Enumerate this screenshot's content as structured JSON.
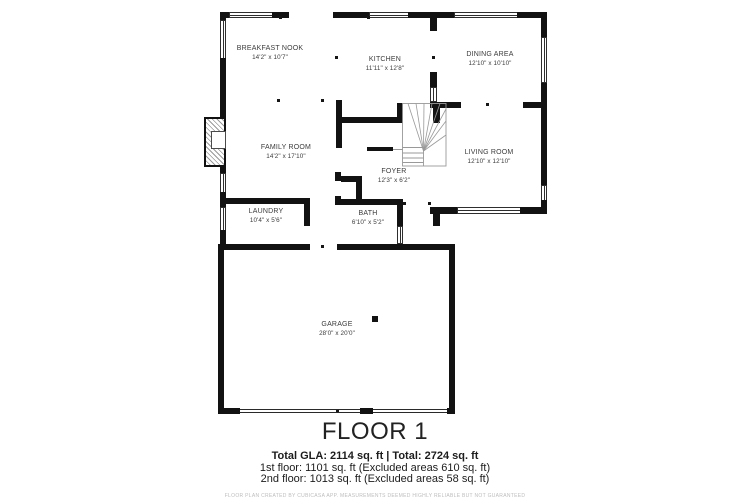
{
  "plan": {
    "floor_title": "FLOOR 1",
    "stats": {
      "total_line": "Total GLA: 2114 sq. ft | Total: 2724 sq. ft",
      "first_floor_line": "1st floor: 1101 sq. ft (Excluded areas 610 sq. ft)",
      "second_floor_line": "2nd floor: 1013 sq. ft (Excluded areas 58 sq. ft)"
    },
    "disclaimer": "FLOOR PLAN CREATED BY CUBICASA APP. MEASUREMENTS DEEMED HIGHLY RELIABLE BUT NOT GUARANTEED",
    "rooms": [
      {
        "name": "BREAKFAST NOOK",
        "dimensions": "14'2\" x 10'7\""
      },
      {
        "name": "KITCHEN",
        "dimensions": "11'11\" x 12'8\""
      },
      {
        "name": "DINING AREA",
        "dimensions": "12'10\" x 10'10\""
      },
      {
        "name": "FAMILY ROOM",
        "dimensions": "14'2\" x 17'10\""
      },
      {
        "name": "LIVING ROOM",
        "dimensions": "12'10\" x 12'10\""
      },
      {
        "name": "FOYER",
        "dimensions": "12'3\" x 6'2\""
      },
      {
        "name": "LAUNDRY",
        "dimensions": "10'4\" x 5'6\""
      },
      {
        "name": "BATH",
        "dimensions": "6'10\" x 5'2\""
      },
      {
        "name": "GARAGE",
        "dimensions": "28'0\" x 20'0\""
      }
    ],
    "colors": {
      "wall": "#121212",
      "label_text": "#3b3b3b",
      "disclaimer_text": "#bdbdbd"
    }
  }
}
